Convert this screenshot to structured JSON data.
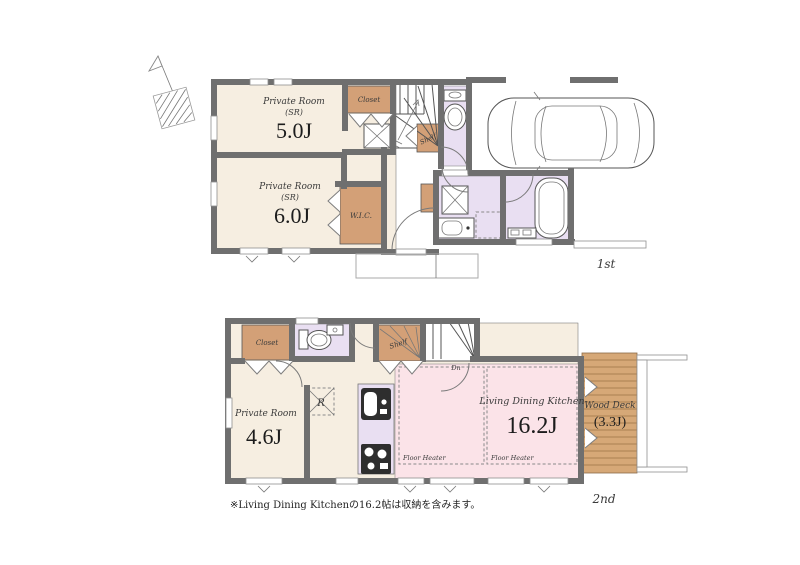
{
  "colors": {
    "wall": "#6f6f6f",
    "room_floor_cream": "#f6eee1",
    "closet_brown": "#d3a077",
    "wet_area_purple": "#e9dff2",
    "ldk_pink": "#fbe3e8",
    "wood_deck_tan": "#d6a877",
    "appliance_dark": "#2e2e2e",
    "line": "#555555"
  },
  "floor1": {
    "label": "1st",
    "room5": {
      "name": "Private Room",
      "type": "(SR)",
      "area": "5.0J"
    },
    "room6": {
      "name": "Private Room",
      "type": "(SR)",
      "area": "6.0J"
    },
    "closet_label": "Closet",
    "wic_label": "W.I.C.",
    "shelf_label": "Shelf"
  },
  "floor2": {
    "label": "2nd",
    "closet_label": "Closet",
    "shelf_label": "Shelf",
    "stairs_label": "Dn",
    "refrigerator_label": "R",
    "room46": {
      "name": "Private Room",
      "area": "4.6J"
    },
    "ldk": {
      "name": "Living Dining Kitchen",
      "area": "16.2J"
    },
    "floor_heater_left": "Floor Heater",
    "floor_heater_right": "Floor Heater",
    "wood_deck": {
      "name": "Wood Deck",
      "area": "(3.3J)"
    }
  },
  "footnote": "※Living Dining Kitchenの16.2帖は収納を含みます。"
}
